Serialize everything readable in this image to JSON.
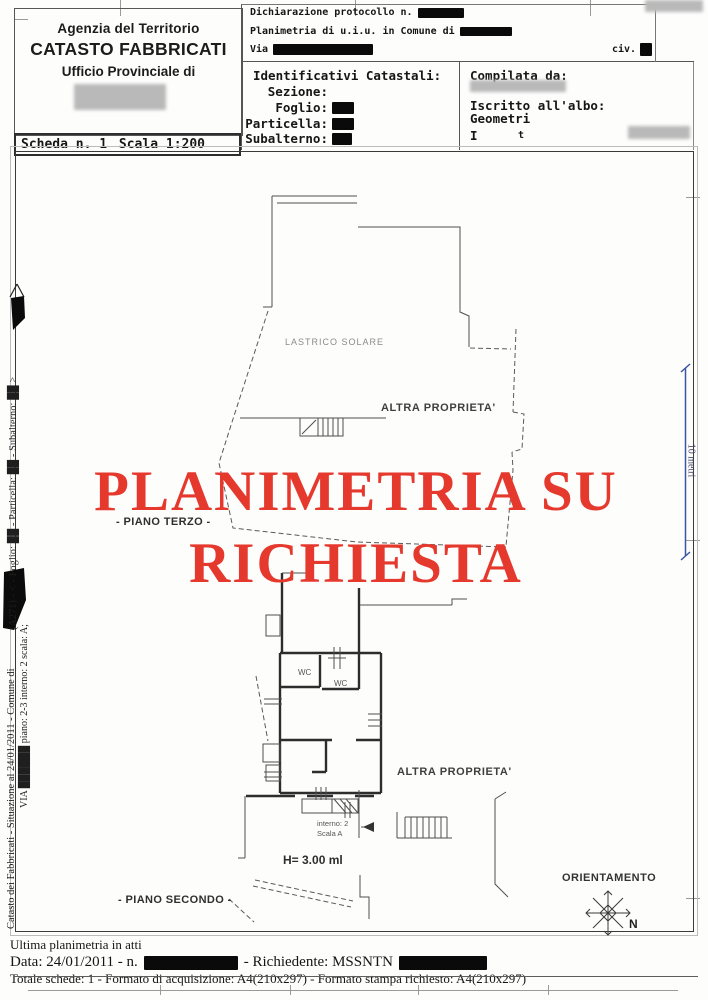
{
  "title": "Planimetria catastale",
  "colors": {
    "stamp_red": "#e6392e",
    "scale_blue": "#3b55a5",
    "ink": "#1c1c1c"
  },
  "header": {
    "agency": "Agenzia del Territorio",
    "registry": "CATASTO FABBRICATI",
    "office_line": "Ufficio Provinciale di",
    "scheda": "Scheda n. 1",
    "scala": "Scala 1:200",
    "protocol": {
      "line1": "Dichiarazione protocollo n.",
      "line2": "Planimetria di u.i.u. in Comune di",
      "via": "Via",
      "civ": "civ."
    },
    "identificativi": {
      "title": "Identificativi Catastali:",
      "sezione": "Sezione:",
      "foglio": "Foglio:",
      "particella": "Particella:",
      "subalterno": "Subalterno:"
    },
    "compilata": {
      "title": "Compilata da:",
      "albo1": "Iscritto all'albo:",
      "albo2": "Geometri",
      "frag1": "I",
      "frag2": "t"
    }
  },
  "left_margin": {
    "upper_vertical": "(A271)  -  <  - Foglio: ██ - Particella: ██ - Subalterno: ██  >",
    "lower_line1": "Catasto dei Fabbricati - Situazione al 24/01/2011 - Comune di",
    "lower_line2": "VIA ██████  piano: 2-3 interno: 2 scala: A;"
  },
  "plan": {
    "stamp_line1": "PLANIMETRIA SU",
    "stamp_line2": "RICHIESTA",
    "lastrico": "LASTRICO SOLARE",
    "altra_top": "ALTRA PROPRIETA'",
    "piano_terzo": "- PIANO TERZO -",
    "wc1": "WC",
    "wc2": "WC",
    "altra_bottom": "ALTRA PROPRIETA'",
    "interno": "interno: 2",
    "scala_interna": "Scala A",
    "altezza": "H= 3.00 ml",
    "piano_secondo": "- PIANO SECONDO -",
    "scale_bar": "10 metri",
    "orientamento": "ORIENTAMENTO",
    "nord": "N"
  },
  "footer": {
    "line1": "Ultima planimetria in atti",
    "line2a": "Data: 24/01/2011 - n.",
    "line2b": "- Richiedente: MSSNTN",
    "line3": "Totale schede: 1 - Formato di acquisizione: A4(210x297) - Formato stampa richiesto: A4(210x297)"
  }
}
